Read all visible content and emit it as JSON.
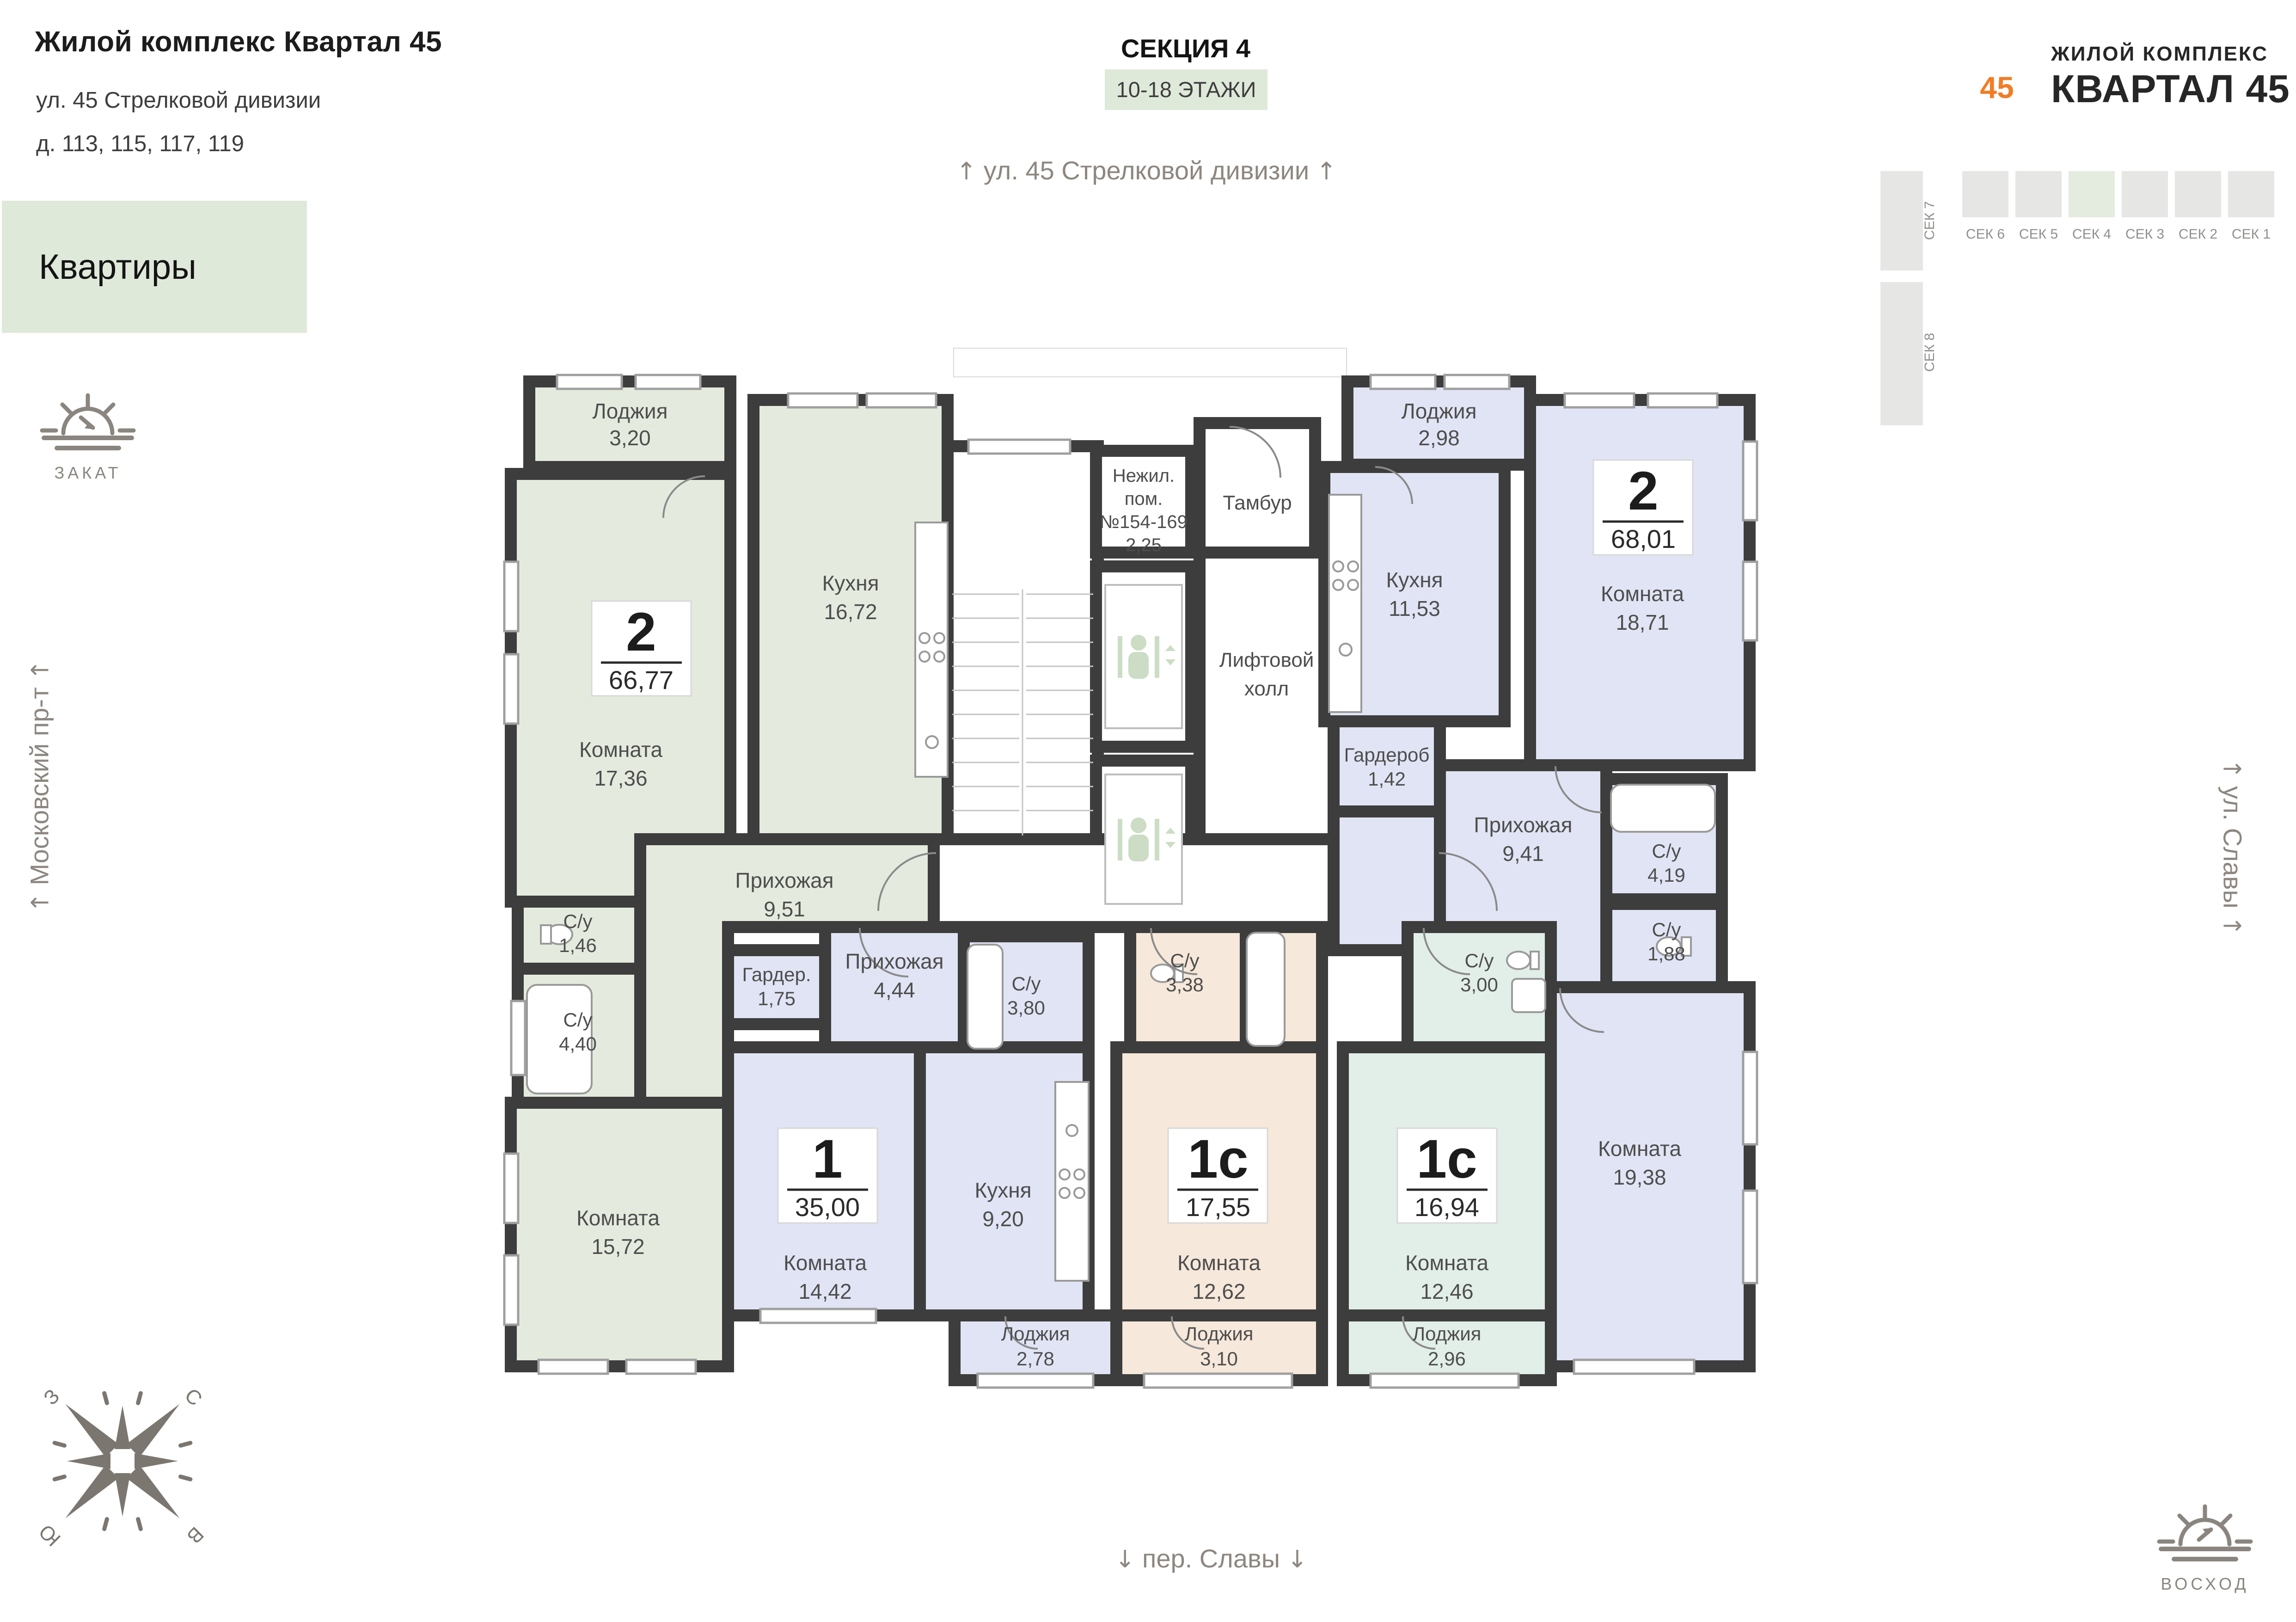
{
  "header": {
    "title": "Жилой комплекс Квартал 45",
    "address_line1": "ул. 45 Стрелковой дивизии",
    "address_line2": "д. 113, 115, 117, 119",
    "apartments_label": "Квартиры"
  },
  "section": {
    "label": "СЕКЦИЯ 4",
    "floors": "10-18 ЭТАЖИ"
  },
  "streets": {
    "top": "ул. 45 Стрелковой дивизии",
    "bottom": "пер. Славы",
    "left": "Московский пр-т",
    "right": "ул. Славы"
  },
  "icons": {
    "arrow_up": "↑",
    "arrow_down": "↓"
  },
  "sun": {
    "sunset": "ЗАКАТ",
    "sunrise": "ВОСХОД"
  },
  "compass": {
    "n": "С",
    "s": "Ю",
    "w": "З",
    "e": "В"
  },
  "logo": {
    "line1": "ЖИЛОЙ КОМПЛЕКС",
    "line2": "КВАРТАЛ 45",
    "star_number": "45"
  },
  "section_map": {
    "active": "СЕК 4",
    "items": [
      "СЕК 7",
      "СЕК 6",
      "СЕК 5",
      "СЕК 4",
      "СЕК 3",
      "СЕК 2",
      "СЕК 1",
      "СЕК 8"
    ]
  },
  "palette": {
    "green": "#e4ebde",
    "lavender": "#e1e4f4",
    "beige": "#f6e8da",
    "teal": "#e2eee8",
    "wall": "#3d3d3d",
    "accent_box": "#dfe9da",
    "logo_red": "#e23726",
    "logo_orange": "#f59121"
  },
  "common": {
    "nonres_l1": "Нежил.",
    "nonres_l2": "пом.",
    "nonres_l3": "№154-169",
    "nonres_l4": "2,25",
    "tambour": "Тамбур",
    "lift_l1": "Лифтовой",
    "lift_l2": "холл"
  },
  "apartments": [
    {
      "id": "apt-2-left",
      "type": "2",
      "area": "66,77",
      "rooms": [
        {
          "name": "Лоджия",
          "area": "3,20"
        },
        {
          "name": "Кухня",
          "area": "16,72"
        },
        {
          "name": "Комната",
          "area": "17,36"
        },
        {
          "name": "С/у",
          "area": "1,46"
        },
        {
          "name": "С/у",
          "area": "4,40"
        },
        {
          "name": "Прихожая",
          "area": "9,51"
        },
        {
          "name": "Комната",
          "area": "15,72"
        }
      ]
    },
    {
      "id": "apt-1-middle",
      "type": "1",
      "area": "35,00",
      "rooms": [
        {
          "name": "Гардер.",
          "area": "1,75"
        },
        {
          "name": "Прихожая",
          "area": "4,44"
        },
        {
          "name": "С/у",
          "area": "3,80"
        },
        {
          "name": "Комната",
          "area": "14,42"
        },
        {
          "name": "Кухня",
          "area": "9,20"
        },
        {
          "name": "Лоджия",
          "area": "2,78"
        }
      ]
    },
    {
      "id": "apt-1c-beige",
      "type": "1с",
      "area": "17,55",
      "rooms": [
        {
          "name": "С/у",
          "area": "3,38"
        },
        {
          "name": "Комната",
          "area": "12,62"
        },
        {
          "name": "Лоджия",
          "area": "3,10"
        }
      ]
    },
    {
      "id": "apt-1c-teal",
      "type": "1с",
      "area": "16,94",
      "rooms": [
        {
          "name": "С/у",
          "area": "3,00"
        },
        {
          "name": "Комната",
          "area": "12,46"
        },
        {
          "name": "Лоджия",
          "area": "2,96"
        }
      ]
    },
    {
      "id": "apt-2-right",
      "type": "2",
      "area": "68,01",
      "rooms": [
        {
          "name": "Лоджия",
          "area": "2,98"
        },
        {
          "name": "Кухня",
          "area": "11,53"
        },
        {
          "name": "Комната",
          "area": "18,71"
        },
        {
          "name": "Гардероб",
          "area": "1,42"
        },
        {
          "name": "Прихожая",
          "area": "9,41"
        },
        {
          "name": "С/у",
          "area": "4,19"
        },
        {
          "name": "С/у",
          "area": "1,88"
        },
        {
          "name": "Комната",
          "area": "19,38"
        }
      ]
    }
  ]
}
